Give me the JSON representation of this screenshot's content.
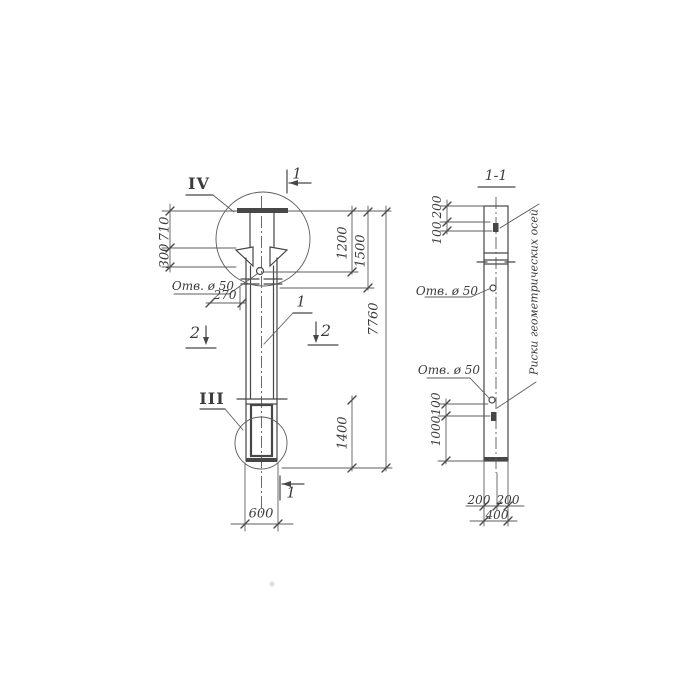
{
  "drawing": {
    "front_view": {
      "detail_marker_top": "IV",
      "detail_marker_bottom": "III",
      "section_cut_1_top": "1",
      "section_cut_1_bottom": "1",
      "section_cut_2_left": "2",
      "section_cut_2_right": "2",
      "part_label": "1",
      "hole_label": "Отв. ø 50",
      "dim_710": "710",
      "dim_300": "300",
      "dim_270": "270",
      "dim_1200": "1200",
      "dim_1500": "1500",
      "dim_7760": "7760",
      "dim_1400": "1400",
      "dim_600": "600"
    },
    "section_view": {
      "title": "1-1",
      "hole_label_upper": "Отв. ø 50",
      "hole_label_lower": "Отв. ø 50",
      "axes_note": "Риски геометрических осей",
      "dim_200_top": "200",
      "dim_100_top": "100",
      "dim_100_bottom": "100",
      "dim_1000": "1000",
      "dim_200_bottom_left": "200",
      "dim_200_bottom_right": "200",
      "dim_400": "400"
    },
    "line_color": "#474747"
  }
}
